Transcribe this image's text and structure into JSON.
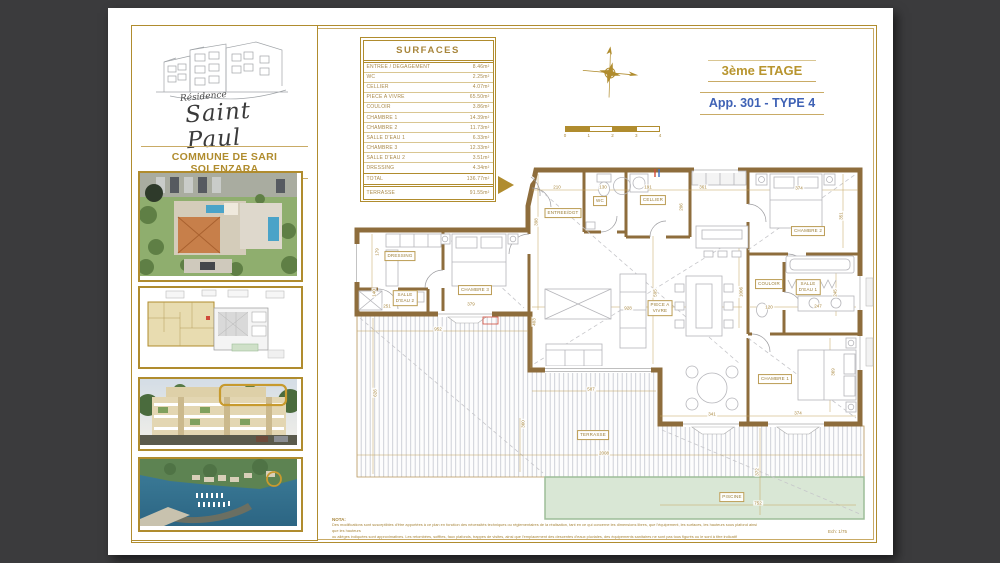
{
  "colors": {
    "gold": "#b08c2e",
    "gold_text": "#a8863c",
    "blue": "#3f62b5",
    "wall": "#8e6d3c",
    "pool": "#d9e7d5"
  },
  "branding": {
    "residence_prefix": "Résidence",
    "residence_name": "Saint Paul",
    "commune": "COMMUNE DE SARI SOLENZARA"
  },
  "header": {
    "floor_title": "3ème ETAGE",
    "apartment_title": "App. 301 - TYPE 4"
  },
  "surfaces_table": {
    "title": "SURFACES",
    "rows": [
      {
        "label": "ENTREE / DEGAGEMENT",
        "value": "8.46m²"
      },
      {
        "label": "WC",
        "value": "2.25m²"
      },
      {
        "label": "CELLIER",
        "value": "4.07m²"
      },
      {
        "label": "PIECE A VIVRE",
        "value": "65.50m²"
      },
      {
        "label": "COULOIR",
        "value": "3.86m²"
      },
      {
        "label": "CHAMBRE 1",
        "value": "14.39m²"
      },
      {
        "label": "CHAMBRE 2",
        "value": "11.73m²"
      },
      {
        "label": "SALLE D'EAU 1",
        "value": "6.33m²"
      },
      {
        "label": "CHAMBRE 3",
        "value": "12.33m²"
      },
      {
        "label": "SALLE D'EAU 2",
        "value": "3.51m²"
      },
      {
        "label": "DRESSING",
        "value": "4.34m²"
      }
    ],
    "total": {
      "label": "TOTAL",
      "value": "136.77m²"
    },
    "terrasse": {
      "label": "TERRASSE",
      "value": "91.55m²"
    }
  },
  "scale_bar": {
    "ticks": [
      "0",
      "1",
      "2",
      "3",
      "4"
    ]
  },
  "plan": {
    "room_labels": [
      {
        "text": "ENTREE/DGT",
        "x": 455,
        "y": 205
      },
      {
        "text": "WC",
        "x": 492,
        "y": 193
      },
      {
        "text": "CELLIER",
        "x": 545,
        "y": 192
      },
      {
        "text": "CHAMBRE 2",
        "x": 700,
        "y": 223
      },
      {
        "text": "SALLE\nD'EAU 1",
        "x": 700,
        "y": 279
      },
      {
        "text": "COULOIR",
        "x": 661,
        "y": 276
      },
      {
        "text": "CHAMBRE 1",
        "x": 667,
        "y": 371
      },
      {
        "text": "PIECE A\nVIVRE",
        "x": 552,
        "y": 300
      },
      {
        "text": "CHAMBRE 3",
        "x": 367,
        "y": 282
      },
      {
        "text": "SALLE\nD'EAU 2",
        "x": 297,
        "y": 290
      },
      {
        "text": "DRESSING",
        "x": 292,
        "y": 248
      },
      {
        "text": "TERRASSE",
        "x": 485,
        "y": 427
      },
      {
        "text": "PISCINE",
        "x": 624,
        "y": 489
      }
    ],
    "dimensions": [
      {
        "t": "210",
        "x": 449,
        "y": 179
      },
      {
        "t": "130",
        "x": 495,
        "y": 179
      },
      {
        "t": "191",
        "x": 540,
        "y": 179
      },
      {
        "t": "361",
        "x": 595,
        "y": 179
      },
      {
        "t": "374",
        "x": 691,
        "y": 180
      },
      {
        "t": "398",
        "x": 428,
        "y": 214,
        "r": 1
      },
      {
        "t": "206",
        "x": 573,
        "y": 199,
        "r": 1
      },
      {
        "t": "351",
        "x": 733,
        "y": 208,
        "r": 1
      },
      {
        "t": "179",
        "x": 269,
        "y": 244,
        "r": 1
      },
      {
        "t": "140",
        "x": 266,
        "y": 285,
        "r": 1
      },
      {
        "t": "251",
        "x": 279,
        "y": 298
      },
      {
        "t": "379",
        "x": 363,
        "y": 296
      },
      {
        "t": "952",
        "x": 330,
        "y": 321
      },
      {
        "t": "595",
        "x": 547,
        "y": 285,
        "r": 1
      },
      {
        "t": "928",
        "x": 520,
        "y": 300
      },
      {
        "t": "1006",
        "x": 633,
        "y": 284,
        "r": 1
      },
      {
        "t": "120",
        "x": 661,
        "y": 299
      },
      {
        "t": "247",
        "x": 710,
        "y": 298
      },
      {
        "t": "245",
        "x": 727,
        "y": 285,
        "r": 1
      },
      {
        "t": "341",
        "x": 604,
        "y": 406
      },
      {
        "t": "374",
        "x": 690,
        "y": 405
      },
      {
        "t": "369",
        "x": 725,
        "y": 364,
        "r": 1
      },
      {
        "t": "626",
        "x": 267,
        "y": 385,
        "r": 1
      },
      {
        "t": "403",
        "x": 426,
        "y": 314,
        "r": 1
      },
      {
        "t": "360",
        "x": 415,
        "y": 416,
        "r": 1
      },
      {
        "t": "587",
        "x": 483,
        "y": 381
      },
      {
        "t": "2008",
        "x": 496,
        "y": 445
      },
      {
        "t": "372",
        "x": 649,
        "y": 464,
        "r": 1
      },
      {
        "t": "752",
        "x": 650,
        "y": 495
      }
    ]
  },
  "nota": {
    "title": "NOTA:",
    "line1": "Des modifications sont susceptibles d'être apportées à ce plan en fonction des nécessités techniques ou réglementaires de la réalisation, tant en ce qui concerne les dimensions libres, que l'équipement, les surfaces, les hauteurs sous plafond ainsi que les hauteurs",
    "line2": "ou allèges indiquées sont approximatives. Les retombées, soffites, faux plafonds, trappes de visites, ainsi que l'emplacement des descentes d'eaux pluviales, des équipements sanitaires ne sont pas tous figurés ou le sont à titre indicatif"
  },
  "scale_note": "Ech: 1/75"
}
